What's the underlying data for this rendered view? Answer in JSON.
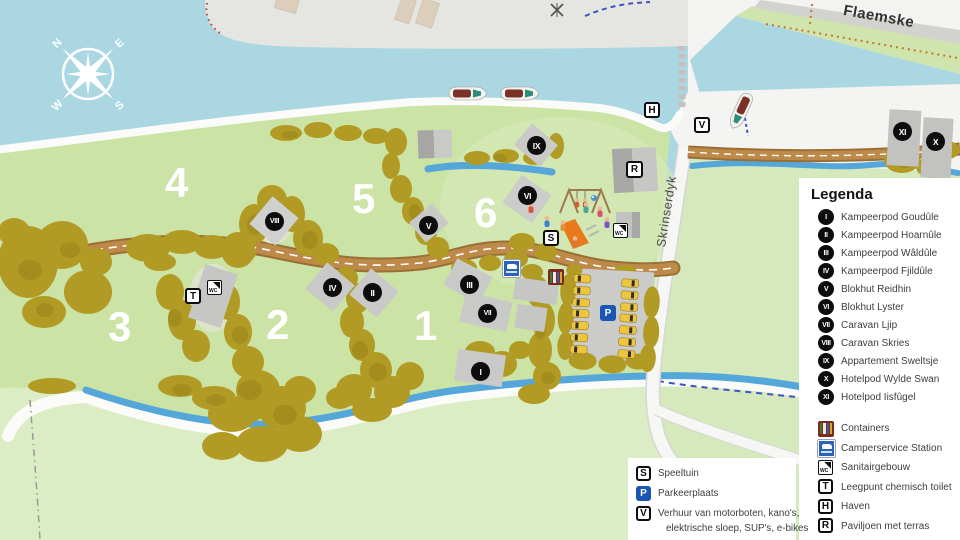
{
  "compass": {
    "n": "N",
    "e": "E",
    "s": "S",
    "w": "W"
  },
  "streets": {
    "skrinserdyk": "Skrinserdyk",
    "flaemske": "Flaemske"
  },
  "zones": {
    "z1": "1",
    "z2": "2",
    "z3": "3",
    "z4": "4",
    "z5": "5",
    "z6": "6"
  },
  "map_markers": {
    "i": "I",
    "ii": "II",
    "iii": "III",
    "iv": "IV",
    "v": "V",
    "vi": "VI",
    "vii": "VII",
    "viii": "VIII",
    "ix": "IX",
    "x": "X",
    "xi": "XI"
  },
  "map_signs": {
    "s": "S",
    "p": "P",
    "t": "T",
    "h": "H",
    "r": "R",
    "v": "V",
    "wc": "WC"
  },
  "legend": {
    "title": "Legenda",
    "accommodations": [
      {
        "numeral": "I",
        "label": "Kampeerpod Goudûle"
      },
      {
        "numeral": "II",
        "label": "Kampeerpod Hoarnûle"
      },
      {
        "numeral": "III",
        "label": "Kampeerpod Wâldûle"
      },
      {
        "numeral": "IV",
        "label": "Kampeerpod Fjildûle"
      },
      {
        "numeral": "V",
        "label": "Blokhut Reidhin"
      },
      {
        "numeral": "VI",
        "label": "Blokhut Lyster"
      },
      {
        "numeral": "VII",
        "label": "Caravan Ljip"
      },
      {
        "numeral": "VIII",
        "label": "Caravan Skries"
      },
      {
        "numeral": "IX",
        "label": "Appartement Sweltsje"
      },
      {
        "numeral": "X",
        "label": "Hotelpod Wylde Swan"
      },
      {
        "numeral": "XI",
        "label": "Hotelpod Iisfûgel"
      }
    ],
    "facilities": [
      {
        "label": "Containers"
      },
      {
        "label": "Camperservice Station"
      },
      {
        "label": "Sanitairgebouw"
      },
      {
        "letter": "T",
        "label": "Leegpunt chemisch toilet"
      },
      {
        "letter": "H",
        "label": "Haven"
      },
      {
        "letter": "R",
        "label": "Paviljoen met terras"
      }
    ],
    "activities": [
      {
        "letter": "S",
        "label": "Speeltuin"
      },
      {
        "letter": "P",
        "label": "Parkeerplaats"
      },
      {
        "letter": "V",
        "label": "Verhuur van motorboten, kano's,",
        "label2": "elektrische sloep, SUP's, e-bikes"
      }
    ]
  },
  "colors": {
    "water": "#abd7e2",
    "campsite_green": "#cce3a6",
    "field_green": "#dcedc6",
    "trees": "#b19b24",
    "road_brown": "#bd8a4a",
    "marker_black": "#0d0d0d",
    "parking_blue": "#1a56b4"
  }
}
